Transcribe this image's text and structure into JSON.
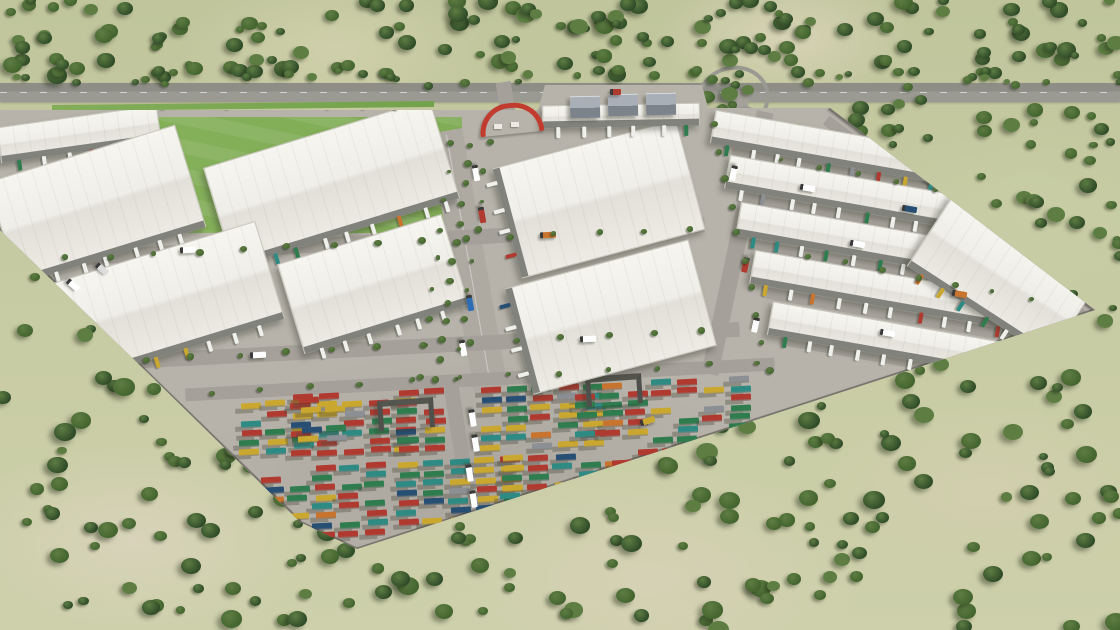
{
  "scene": {
    "description": "Aerial 3D architectural rendering of an industrial logistics park: rows of white flat-roof warehouses with loading docks and trucks, a tree-lined central boulevard with a red entrance arch, a large container yard with colorful shipping containers and gantry cranes, a green sports field, a highway along the top edge, all surrounded by scrubland dotted with dark green trees",
    "palette": {
      "terrain_base": "#c3c8a0",
      "terrain_patch_light": "#d8d3ba",
      "tree_dark": "#2f4b28",
      "tree_mid": "#44642f",
      "tree_light": "#5d7d43",
      "highway_gray": "#8e8e87",
      "pavement": "#b7b3ab",
      "road_gray": "#a5a19a",
      "roof_white": "#f6f5f0",
      "roof_shade": "#e2e0d8",
      "dock_gray": "#82827c",
      "unit_gray": "#7d838b",
      "perimeter_wall": "#76746c",
      "field_green": "#7fae57",
      "entrance_arch_red": "#c23b2f",
      "crane_gray": "#4f4f4b",
      "container_colors": [
        "#b03a30",
        "#2f7d4f",
        "#caa82f",
        "#2e8b83",
        "#c9742e",
        "#8c8f94",
        "#274e73"
      ],
      "trailer_white": "#efefec"
    },
    "counts": {
      "warehouse_blocks": 14,
      "container_blocks": 10,
      "gantry_cranes": 2,
      "tree_regions": 5
    }
  },
  "render": {
    "seed": 20240613,
    "complex_polygon": [
      [
        0,
        110
      ],
      [
        538,
        110
      ],
      [
        545,
        85
      ],
      [
        702,
        85
      ],
      [
        708,
        108
      ],
      [
        830,
        108
      ],
      [
        1095,
        310
      ],
      [
        357,
        549
      ],
      [
        300,
        522
      ],
      [
        150,
        375
      ],
      [
        0,
        230
      ]
    ],
    "field": [
      [
        150,
        117
      ],
      [
        462,
        117
      ],
      [
        462,
        233
      ],
      [
        172,
        233
      ]
    ],
    "green_strip": [
      [
        713,
        124
      ],
      [
        800,
        124
      ],
      [
        807,
        143
      ],
      [
        720,
        143
      ]
    ],
    "tree_regions": [
      {
        "x": 0,
        "y": 0,
        "w": 1120,
        "h": 78,
        "n": 160,
        "min": 8,
        "max": 20
      },
      {
        "x": 0,
        "y": 70,
        "w": 1120,
        "h": 16,
        "n": 36,
        "min": 6,
        "max": 11
      },
      {
        "x": 660,
        "y": 86,
        "w": 460,
        "h": 240,
        "n": 130,
        "min": 8,
        "max": 18
      },
      {
        "x": 290,
        "y": 355,
        "w": 830,
        "h": 275,
        "n": 160,
        "min": 9,
        "max": 22
      },
      {
        "x": 0,
        "y": 225,
        "w": 320,
        "h": 405,
        "n": 95,
        "min": 9,
        "max": 22
      }
    ],
    "street_tree_lines": [
      {
        "x1": 470,
        "y1": 146,
        "x2": 437,
        "y2": 380,
        "n": 13,
        "s": 6
      },
      {
        "x1": 452,
        "y1": 142,
        "x2": 420,
        "y2": 376,
        "n": 9,
        "s": 4
      },
      {
        "x1": 489,
        "y1": 142,
        "x2": 456,
        "y2": 378,
        "n": 9,
        "s": 4
      },
      {
        "x1": 22,
        "y1": 260,
        "x2": 688,
        "y2": 228,
        "n": 16,
        "s": 5
      },
      {
        "x1": 100,
        "y1": 362,
        "x2": 700,
        "y2": 332,
        "n": 14,
        "s": 5
      },
      {
        "x1": 714,
        "y1": 124,
        "x2": 768,
        "y2": 370,
        "n": 10,
        "s": 5
      },
      {
        "x1": 212,
        "y1": 392,
        "x2": 758,
        "y2": 362,
        "n": 12,
        "s": 4
      },
      {
        "x1": 62,
        "y1": 106,
        "x2": 430,
        "y2": 106,
        "n": 12,
        "s": 4
      },
      {
        "x1": 782,
        "y1": 160,
        "x2": 1010,
        "y2": 206,
        "n": 7,
        "s": 4
      },
      {
        "x1": 808,
        "y1": 255,
        "x2": 1030,
        "y2": 300,
        "n": 7,
        "s": 4
      }
    ],
    "roads": [
      {
        "cx": 468,
        "cy": 260,
        "w": 34,
        "h": 262,
        "rot": -10,
        "main": true
      },
      {
        "cx": 737,
        "cy": 243,
        "w": 17,
        "h": 268,
        "rot": 12
      },
      {
        "cx": 350,
        "cy": 243,
        "w": 710,
        "h": 15,
        "rot": -3
      },
      {
        "cx": 395,
        "cy": 347,
        "w": 690,
        "h": 15,
        "rot": -3
      },
      {
        "cx": 480,
        "cy": 379,
        "w": 590,
        "h": 13,
        "rot": -3
      },
      {
        "cx": 185,
        "cy": 268,
        "w": 330,
        "h": 12,
        "rot": -17
      },
      {
        "cx": 855,
        "cy": 172,
        "w": 250,
        "h": 11,
        "rot": 10
      },
      {
        "cx": 872,
        "cy": 220,
        "w": 270,
        "h": 11,
        "rot": 10
      },
      {
        "cx": 886,
        "cy": 268,
        "w": 280,
        "h": 11,
        "rot": 10
      },
      {
        "cx": 900,
        "cy": 316,
        "w": 280,
        "h": 11,
        "rot": 10
      },
      {
        "cx": 912,
        "cy": 362,
        "w": 270,
        "h": 11,
        "rot": 10
      },
      {
        "cx": 955,
        "cy": 218,
        "w": 325,
        "h": 11,
        "rot": 37.3
      },
      {
        "cx": 463,
        "cy": 465,
        "w": 15,
        "h": 170,
        "rot": -9
      },
      {
        "cx": 720,
        "cy": 436,
        "w": 740,
        "h": 12,
        "rot": -18
      }
    ],
    "walls": [
      {
        "cx": 150,
        "cy": 376,
        "len": 418,
        "rot": 44.2
      },
      {
        "cx": 328,
        "cy": 536,
        "len": 64,
        "rot": 25.3
      },
      {
        "cx": 726,
        "cy": 430,
        "len": 776,
        "rot": -17.95
      },
      {
        "cx": 962,
        "cy": 209,
        "len": 333,
        "rot": 37.3
      }
    ],
    "warehouses": [
      {
        "cx": 78,
        "cy": 133,
        "w": 160,
        "h": 34,
        "rot": -8,
        "dock": "bottom"
      },
      {
        "cx": 95,
        "cy": 203,
        "w": 195,
        "h": 105,
        "rot": -17,
        "dock": "bottom"
      },
      {
        "cx": 330,
        "cy": 182,
        "w": 235,
        "h": 102,
        "rot": -17,
        "dock": "bottom"
      },
      {
        "cx": 160,
        "cy": 302,
        "w": 225,
        "h": 100,
        "rot": -17,
        "dock": "bottom"
      },
      {
        "cx": 372,
        "cy": 283,
        "w": 170,
        "h": 92,
        "rot": -17,
        "dock": "bottom"
      },
      {
        "cx": 598,
        "cy": 198,
        "w": 188,
        "h": 112,
        "rot": -15,
        "dock": "left"
      },
      {
        "cx": 610,
        "cy": 316,
        "w": 188,
        "h": 108,
        "rot": -15,
        "dock": "left"
      },
      {
        "cx": 620,
        "cy": 114,
        "w": 156,
        "h": 21,
        "rot": -1,
        "dock": "bottom"
      },
      {
        "cx": 828,
        "cy": 146,
        "w": 235,
        "h": 32,
        "rot": 10,
        "dock": "bottom"
      },
      {
        "cx": 860,
        "cy": 194,
        "w": 270,
        "h": 32,
        "rot": 10,
        "dock": "bottom"
      },
      {
        "cx": 876,
        "cy": 242,
        "w": 280,
        "h": 32,
        "rot": 10,
        "dock": "bottom"
      },
      {
        "cx": 890,
        "cy": 290,
        "w": 280,
        "h": 32,
        "rot": 10,
        "dock": "bottom"
      },
      {
        "cx": 888,
        "cy": 338,
        "w": 240,
        "h": 32,
        "rot": 10,
        "dock": "bottom"
      },
      {
        "cx": 1000,
        "cy": 276,
        "w": 168,
        "h": 82,
        "rot": 33,
        "dock": "bottom"
      }
    ],
    "gray_units": [
      {
        "x": 570,
        "y": 96,
        "w": 30,
        "h": 21,
        "rot": -1
      },
      {
        "x": 608,
        "y": 94,
        "w": 30,
        "h": 21,
        "rot": -1
      },
      {
        "x": 646,
        "y": 93,
        "w": 30,
        "h": 21,
        "rot": -1
      }
    ],
    "container_blocks": [
      {
        "x": 240,
        "y": 402,
        "cols": 3,
        "rows": 6,
        "d": 0.7
      },
      {
        "x": 292,
        "y": 394,
        "cols": 5,
        "rows": 7,
        "d": 0.78
      },
      {
        "x": 300,
        "y": 398,
        "cols": 2,
        "rows": 5,
        "d": 0.6
      },
      {
        "x": 398,
        "y": 390,
        "cols": 2,
        "rows": 7,
        "d": 0.85
      },
      {
        "x": 480,
        "y": 388,
        "cols": 5,
        "rows": 7,
        "d": 0.78
      },
      {
        "x": 575,
        "y": 384,
        "cols": 3,
        "rows": 6,
        "d": 0.8
      },
      {
        "x": 652,
        "y": 380,
        "cols": 4,
        "rows": 7,
        "d": 0.85
      },
      {
        "x": 262,
        "y": 468,
        "cols": 5,
        "rows": 8,
        "d": 0.72
      },
      {
        "x": 398,
        "y": 462,
        "cols": 5,
        "rows": 8,
        "d": 0.8
      },
      {
        "x": 502,
        "y": 456,
        "cols": 5,
        "rows": 8,
        "d": 0.8
      },
      {
        "x": 612,
        "y": 450,
        "cols": 3,
        "rows": 6,
        "d": 0.8
      }
    ],
    "container_geom": {
      "w": 20,
      "h": 6.5,
      "gx": 26,
      "gy": 9.5,
      "rot": -3
    },
    "cranes": [
      {
        "x": 378,
        "y": 399,
        "rot": -4
      },
      {
        "x": 586,
        "y": 375,
        "rot": -4
      }
    ],
    "vehicles": [
      [
        150,
        88,
        0,
        "#ffffff",
        12
      ],
      [
        320,
        94,
        0,
        "#d0d0d0",
        11
      ],
      [
        610,
        89,
        0,
        "#b03a30",
        11
      ],
      [
        900,
        96,
        3,
        "#ffffff",
        12
      ],
      [
        1050,
        92,
        3,
        "#274e73",
        11
      ],
      [
        468,
        170,
        80,
        "#ffffff",
        16
      ],
      [
        474,
        212,
        80,
        "#b03a30",
        16
      ],
      [
        462,
        300,
        80,
        "#2e6db4",
        16
      ],
      [
        455,
        345,
        80,
        "#ffffff",
        16
      ],
      [
        180,
        247,
        -3,
        "#ffffff",
        16
      ],
      [
        540,
        232,
        -3,
        "#c9742e",
        16
      ],
      [
        250,
        352,
        -3,
        "#ffffff",
        16
      ],
      [
        580,
        336,
        -3,
        "#ffffff",
        16
      ],
      [
        726,
        170,
        102,
        "#ffffff",
        15
      ],
      [
        738,
        262,
        102,
        "#b03a30",
        15
      ],
      [
        748,
        322,
        102,
        "#ffffff",
        15
      ],
      [
        800,
        185,
        10,
        "#ffffff",
        15
      ],
      [
        902,
        206,
        10,
        "#274e73",
        15
      ],
      [
        850,
        241,
        10,
        "#ffffff",
        15
      ],
      [
        952,
        291,
        10,
        "#c9742e",
        15
      ],
      [
        880,
        330,
        10,
        "#ffffff",
        15
      ],
      [
        975,
        352,
        10,
        "#ffffff",
        15
      ],
      [
        464,
        415,
        81,
        "#ffffff",
        17
      ],
      [
        467,
        440,
        81,
        "#ffffff",
        17
      ],
      [
        461,
        470,
        81,
        "#ffffff",
        17
      ],
      [
        465,
        496,
        81,
        "#ffffff",
        17
      ],
      [
        459,
        521,
        81,
        "#ffffff",
        17
      ],
      [
        66,
        282,
        40,
        "#ffffff",
        14
      ],
      [
        95,
        266,
        40,
        "#dddddd",
        14
      ],
      [
        640,
        418,
        -18,
        "#caa82f",
        15
      ]
    ],
    "entrance": {
      "arch": {
        "x": 479,
        "y": 103,
        "w": 54,
        "h": 26,
        "rot": -6
      },
      "booths": [
        [
          494,
          124
        ],
        [
          511,
          122
        ]
      ],
      "stub": {
        "cx": 505,
        "cy": 97,
        "w": 15,
        "h": 30,
        "rot": -9
      }
    },
    "secondary_access": {
      "loop": {
        "x": 696,
        "y": 66,
        "w": 66,
        "h": 58,
        "rot": -18
      },
      "roundabout": {
        "x": 735,
        "y": 106,
        "d": 15
      },
      "stub": {
        "cx": 741,
        "cy": 112,
        "w": 12,
        "h": 42,
        "rot": 9
      }
    },
    "verge": {
      "x": 52,
      "y": 103,
      "w": 382,
      "h": 6,
      "rot": -0.6
    }
  }
}
